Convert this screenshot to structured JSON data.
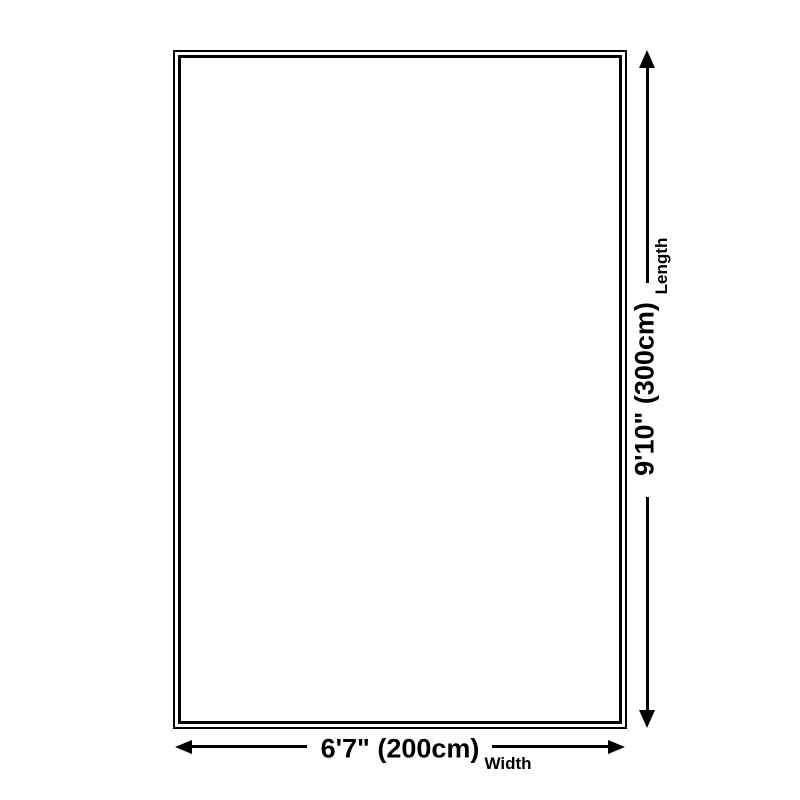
{
  "canvas": {
    "background_color": "#ffffff",
    "ink_color": "#000000"
  },
  "rug_diagram": {
    "shape": "rectangle",
    "length_dimension": {
      "value": "9'10\" (300cm)",
      "label": "Length"
    },
    "width_dimension": {
      "value": "6'7\" (200cm)",
      "label": "Width"
    }
  }
}
